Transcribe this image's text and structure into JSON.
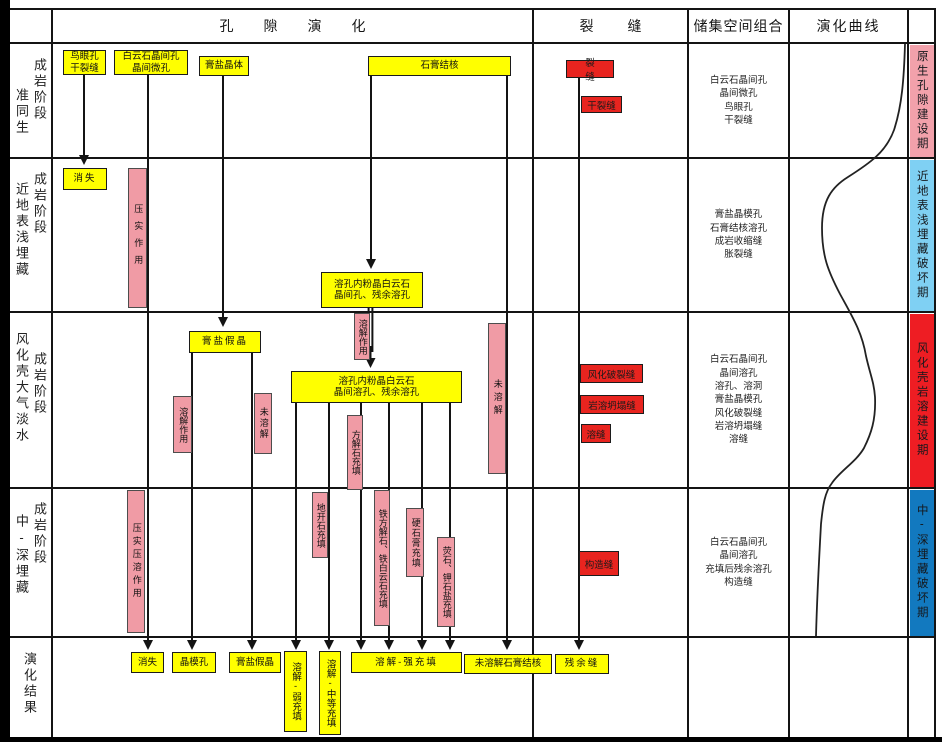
{
  "header": {
    "pore_evolution": "孔隙演化",
    "fracture": "裂缝",
    "space_combination": "储集空间组合",
    "evolution_curve": "演化曲线"
  },
  "stages": [
    {
      "name": "准同生",
      "suffix": "成岩阶段"
    },
    {
      "name": "近地表浅埋藏",
      "suffix": "成岩阶段"
    },
    {
      "name": "风化壳大气淡水",
      "suffix": "成岩阶段"
    },
    {
      "name": "中-深埋藏",
      "suffix": "成岩阶段"
    },
    {
      "name": "演化结果",
      "suffix": ""
    }
  ],
  "pore": {
    "bird_eye_pores": "鸟眼孔\n干裂缝",
    "dolomite_intercrystal": "白云石晶间孔\n晶间微孔",
    "gypsum_salt_crystal": "膏盐晶体",
    "gypsum_nodule": "石膏结核",
    "disappear_row2": "消失",
    "dissolved_pore_row2": "溶孔内粉晶白云石\n晶间孔、残余溶孔",
    "gypsum_pseudomorph_row3": "膏盐假晶",
    "dissolved_pore_row3": "溶孔内粉晶白云石\n晶间溶孔、残余溶孔"
  },
  "actions": {
    "compaction": "压实作用",
    "dissolution_mid": "溶解作用",
    "dissolution_row3": "溶解作用",
    "undissolved_left": "未溶解",
    "undissolved_right": "未溶解",
    "calcite_fill": "方解石充填",
    "compaction_pressure_solution": "压实压溶作用",
    "dickite_fill": "地开石充填",
    "fe_calcite_fe_dolomite_fill": "铁方解石、铁白云石充填",
    "anhydrite_fill": "硬石膏充填",
    "fluorite_sylvite_fill": "荧石、钾石盐充填"
  },
  "fractures": {
    "fracture": "裂缝",
    "desiccation_fracture": "干裂缝",
    "weathering_fracture": "风化破裂缝",
    "karst_collapse_fracture": "岩溶坍塌缝",
    "dissolution_fracture": "溶缝",
    "tectonic_fracture": "构造缝"
  },
  "results": {
    "disappear": "消失",
    "crystal_mold_pore": "晶模孔",
    "gypsum_pseudomorph": "膏盐假晶",
    "dissolution_weak_fill": "溶解-弱充填",
    "dissolution_medium_fill": "溶解-中等充填",
    "dissolution_strong_fill": "溶解-强充填",
    "undissolved_gypsum_nodule": "未溶解石膏结核",
    "residual_fracture": "残余缝"
  },
  "space_combination": {
    "row1": "白云石晶间孔\n晶间微孔\n鸟眼孔\n干裂缝",
    "row2": "膏盐晶模孔\n石膏结核溶孔\n成岩收缩缝\n胀裂缝",
    "row3": "白云石晶间孔\n晶间溶孔\n溶孔、溶洞\n膏盐晶模孔\n风化破裂缝\n岩溶坍塌缝\n溶缝",
    "row4": "白云石晶间孔\n晶间溶孔\n充填后残余溶孔\n构造缝",
    "row5": ""
  },
  "periods": {
    "row1": {
      "label": "原生孔隙建设期",
      "color": "#f2a1ab"
    },
    "row2": {
      "label": "近地表浅埋藏破坏期",
      "color": "#7fd0f3"
    },
    "row3": {
      "label": "风化壳岩溶建设期",
      "color": "#ee1d23"
    },
    "row4": {
      "label": "中-深埋藏破坏期",
      "color": "#1279bf"
    }
  },
  "colors": {
    "box_yellow": "#ffff00",
    "box_red": "#e8241f",
    "box_pink": "#f09ba5",
    "line_black": "#141414"
  }
}
